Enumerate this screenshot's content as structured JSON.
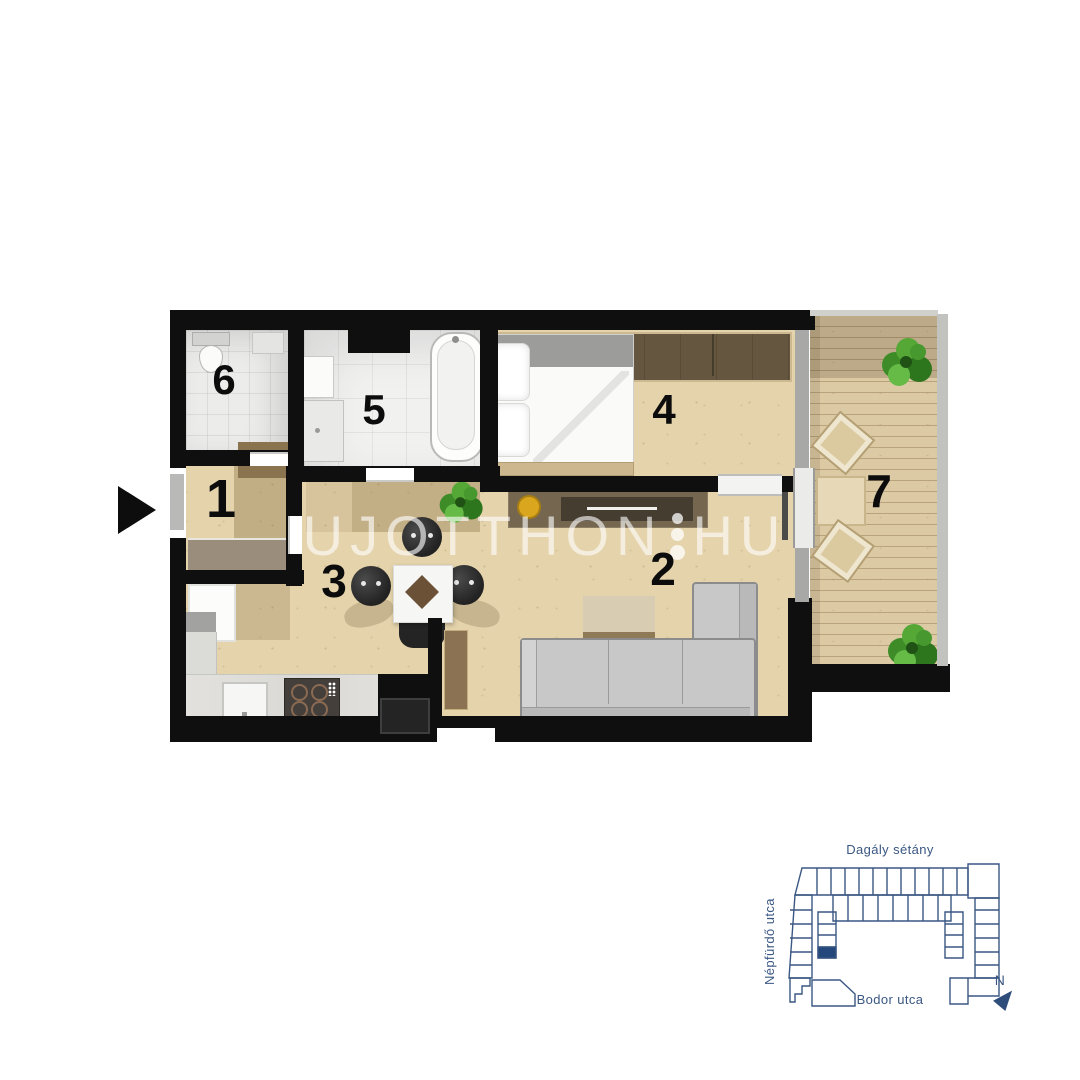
{
  "floor_plan": {
    "rooms": [
      {
        "number": "1",
        "name": "entry-hall"
      },
      {
        "number": "2",
        "name": "living-room"
      },
      {
        "number": "3",
        "name": "kitchen-dining"
      },
      {
        "number": "4",
        "name": "bedroom"
      },
      {
        "number": "5",
        "name": "bathroom"
      },
      {
        "number": "6",
        "name": "wc"
      },
      {
        "number": "7",
        "name": "terrace"
      }
    ],
    "watermark": {
      "left": "UJOTTHON",
      "right": "HU",
      "separator": "three-dots"
    },
    "entrance": {
      "marker": "black-triangle-arrow",
      "side": "left"
    },
    "colors": {
      "wall": "#0f0f0f",
      "wood_floor": "#e4d3ab",
      "terrace_deck": "#dccaa5",
      "tile_floor": "#f1f1f0",
      "sofa": "#c8c8c8",
      "wardrobe": "#65563f",
      "bowl_accent": "#d9a61e"
    }
  },
  "site_map": {
    "street_top": "Dagály sétány",
    "street_left": "Népfürdő utca",
    "street_bottom": "Bodor utca",
    "compass_label": "N",
    "outline_color": "#3a5783",
    "highlight_color": "#24477c"
  }
}
